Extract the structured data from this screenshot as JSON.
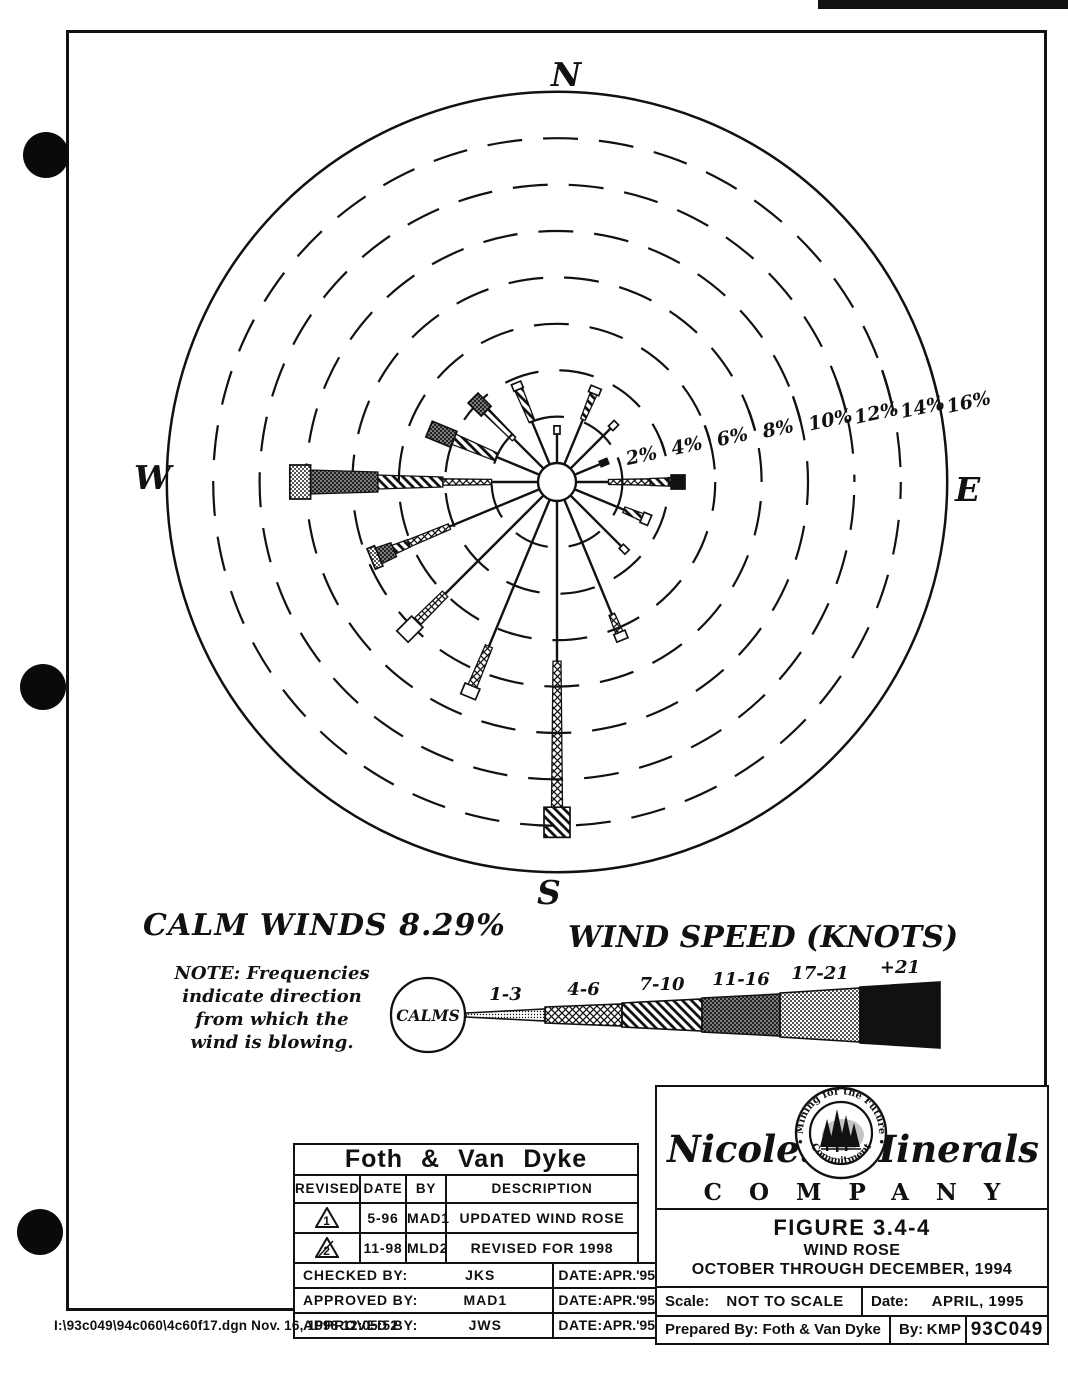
{
  "page": {
    "compass": {
      "n": "N",
      "e": "E",
      "s": "S",
      "w": "W"
    },
    "calm_winds_label": "CALM WINDS 8.29%",
    "note_lines": [
      "NOTE: Frequencies",
      "indicate direction",
      "from which the",
      "wind is blowing."
    ],
    "footer_path": "I:\\93c049\\94c060\\4c60f17.dgn  Nov. 16, 1998  12:05:52"
  },
  "chart_data": {
    "type": "windrose-polar-bar",
    "title": "WIND ROSE — OCTOBER THROUGH DECEMBER, 1994",
    "units": "percent frequency by direction wind is blowing from",
    "calm_percent": 8.29,
    "ring_percents": [
      2,
      4,
      6,
      8,
      10,
      12,
      14,
      16
    ],
    "ring_labels": [
      "2%",
      "4%",
      "6%",
      "8%",
      "10%",
      "12%",
      "14%",
      "16%"
    ],
    "speed_classes": [
      {
        "cls": "k13",
        "label": "1-3",
        "pattern": "fine-speckle"
      },
      {
        "cls": "k46",
        "label": "4-6",
        "pattern": "crosshatch"
      },
      {
        "cls": "k710",
        "label": "7-10",
        "pattern": "diagonal-stripes"
      },
      {
        "cls": "k1116",
        "label": "11-16",
        "pattern": "dark-stipple"
      },
      {
        "cls": "k1721",
        "label": "17-21",
        "pattern": "light-stipple"
      },
      {
        "cls": "k21",
        "label": "+21",
        "pattern": "solid-black"
      }
    ],
    "petals": [
      {
        "dir": "N",
        "deg": 0,
        "total": 1.6,
        "stem_to": 1.25,
        "segs": [],
        "cap": [
          "open",
          1.25,
          1.6,
          3
        ]
      },
      {
        "dir": "NNE",
        "deg": 22.5,
        "total": 3.6,
        "stem_to": 2.1,
        "segs": [
          [
            "k710",
            2.1,
            3.3,
            2.5,
            3.5
          ]
        ],
        "cap": [
          "open",
          3.3,
          3.6,
          5.5
        ]
      },
      {
        "dir": "NE",
        "deg": 45,
        "total": 2.8,
        "stem_to": 2.45,
        "segs": [],
        "cap": [
          "open",
          2.45,
          2.8,
          3.2
        ]
      },
      {
        "dir": "ENE",
        "deg": 67.5,
        "total": 1.55,
        "stem_to": 1.2,
        "segs": [],
        "cap": [
          "k21",
          1.2,
          1.55,
          2.8
        ]
      },
      {
        "dir": "E",
        "deg": 90,
        "total": 4.7,
        "stem_to": 1.4,
        "segs": [
          [
            "k46",
            1.4,
            3.2,
            2.5,
            3.2
          ],
          [
            "k710",
            3.2,
            4.1,
            3.5,
            4.2
          ]
        ],
        "cap": [
          "k21",
          4.1,
          4.7,
          7
        ]
      },
      {
        "dir": "ESE",
        "deg": 112.5,
        "total": 3.5,
        "stem_to": 2.3,
        "segs": [
          [
            "k710",
            2.3,
            3.15,
            3,
            3.8
          ]
        ],
        "cap": [
          "open",
          3.15,
          3.5,
          5.5
        ]
      },
      {
        "dir": "SE",
        "deg": 135,
        "total": 3.45,
        "stem_to": 3.1,
        "segs": [],
        "cap": [
          "open",
          3.1,
          3.45,
          3
        ]
      },
      {
        "dir": "SSE",
        "deg": 157.5,
        "total": 6.55,
        "stem_to": 5.35,
        "segs": [
          [
            "k46",
            5.35,
            6.2,
            3,
            3.8
          ]
        ],
        "cap": [
          "open",
          6.2,
          6.55,
          6
        ]
      },
      {
        "dir": "S",
        "deg": 180,
        "total": 14.5,
        "stem_to": 6.9,
        "segs": [
          [
            "k46",
            6.9,
            13.2,
            4,
            5.5
          ]
        ],
        "cap": [
          "k710",
          13.2,
          14.5,
          13
        ]
      },
      {
        "dir": "SSW",
        "deg": 202.5,
        "total": 9.2,
        "stem_to": 6.85,
        "segs": [
          [
            "k46",
            6.85,
            8.7,
            3.8,
            4.6
          ]
        ],
        "cap": [
          "open",
          8.7,
          9.2,
          8
        ]
      },
      {
        "dir": "SW",
        "deg": 225,
        "total": 8.6,
        "stem_to": 6.0,
        "segs": [
          [
            "k46",
            6.0,
            7.7,
            3.8,
            4.6
          ]
        ],
        "cap": [
          "open",
          7.7,
          8.6,
          8
        ]
      },
      {
        "dir": "WSW",
        "deg": 247.5,
        "total": 7.85,
        "stem_to": 4.2,
        "segs": [
          [
            "k46",
            4.2,
            6.1,
            3,
            3.6
          ],
          [
            "k710",
            6.1,
            6.8,
            4,
            4.6
          ],
          [
            "k1116",
            6.8,
            7.5,
            7.5,
            8.5
          ]
        ],
        "cap": [
          "k1721",
          7.5,
          7.85,
          11
        ]
      },
      {
        "dir": "W",
        "deg": 270,
        "total": 10.7,
        "stem_to": 2.0,
        "segs": [
          [
            "k46",
            2.0,
            4.1,
            2.6,
            3.2
          ],
          [
            "k710",
            4.1,
            6.9,
            5,
            7
          ],
          [
            "k1116",
            6.9,
            9.8,
            10,
            12
          ]
        ],
        "cap": [
          "k1721",
          9.8,
          10.7,
          17
        ]
      },
      {
        "dir": "WNW",
        "deg": 292.5,
        "total": 5.15,
        "stem_to": 2.0,
        "segs": [
          [
            "k710",
            2.0,
            4.0,
            4,
            5.5
          ]
        ],
        "cap": [
          "k1116",
          4.0,
          5.15,
          8.5
        ]
      },
      {
        "dir": "NW",
        "deg": 315,
        "total": 4.3,
        "stem_to": 1.8,
        "segs": [
          [
            "k710",
            1.8,
            3.5,
            2.5,
            3.5
          ]
        ],
        "cap": [
          "k1116",
          3.5,
          4.3,
          7
        ]
      },
      {
        "dir": "NNW",
        "deg": 337.5,
        "total": 3.8,
        "stem_to": 2.0,
        "segs": [
          [
            "k710",
            2.0,
            3.5,
            3,
            4
          ]
        ],
        "cap": [
          "open",
          3.5,
          3.8,
          5
        ]
      }
    ]
  },
  "legend": {
    "title": "WIND SPEED (KNOTS)",
    "calms_label": "CALMS",
    "classes": [
      {
        "label": "1-3",
        "cls": "k13",
        "x1": 86,
        "x2": 165,
        "h1": 2,
        "h2": 6
      },
      {
        "label": "4-6",
        "cls": "k46",
        "x1": 165,
        "x2": 242,
        "h1": 8,
        "h2": 11
      },
      {
        "label": "7-10",
        "cls": "k710",
        "x1": 242,
        "x2": 322,
        "h1": 12,
        "h2": 16
      },
      {
        "label": "11-16",
        "cls": "k1116",
        "x1": 322,
        "x2": 400,
        "h1": 17,
        "h2": 21
      },
      {
        "label": "17-21",
        "cls": "k1721",
        "x1": 400,
        "x2": 480,
        "h1": 22,
        "h2": 27
      },
      {
        "label": "+21",
        "cls": "k21",
        "x1": 480,
        "x2": 560,
        "h1": 28,
        "h2": 33
      }
    ]
  },
  "title_block": {
    "firm": "Foth & Van Dyke",
    "columns": [
      "REVISED",
      "DATE",
      "BY",
      "DESCRIPTION"
    ],
    "rev_rows": [
      {
        "rev": "1",
        "date": "5-96",
        "by": "MAD1",
        "desc": "UPDATED WIND ROSE"
      },
      {
        "rev": "2",
        "date": "11-98",
        "by": "MLD2",
        "desc": "REVISED FOR 1998 UPDATE"
      }
    ],
    "signoff_rows": [
      {
        "label": "CHECKED BY:",
        "name": "JKS",
        "date_label": "DATE:",
        "date": "APR.'95"
      },
      {
        "label": "APPROVED BY:",
        "name": "MAD1",
        "date_label": "DATE:",
        "date": "APR.'95"
      },
      {
        "label": "APPROVED BY:",
        "name": "JWS",
        "date_label": "DATE:",
        "date": "APR.'95"
      }
    ]
  },
  "company_block": {
    "name_left": "Nicolet",
    "name_right": "Minerals",
    "company_word": "COMPANY",
    "seal_top": "• Mining for the Future •",
    "seal_bottom": "Commitment",
    "figure_title": "FIGURE 3.4-4",
    "figure_sub1": "WIND ROSE",
    "figure_sub2": "OCTOBER THROUGH DECEMBER, 1994",
    "scale_label": "Scale:",
    "scale_value": "NOT TO SCALE",
    "date_label": "Date:",
    "date_value": "APRIL, 1995",
    "prepared_label": "Prepared By: Foth & Van Dyke",
    "by_label": "By:",
    "by_value": "KMP",
    "doc_number": "93C049"
  }
}
